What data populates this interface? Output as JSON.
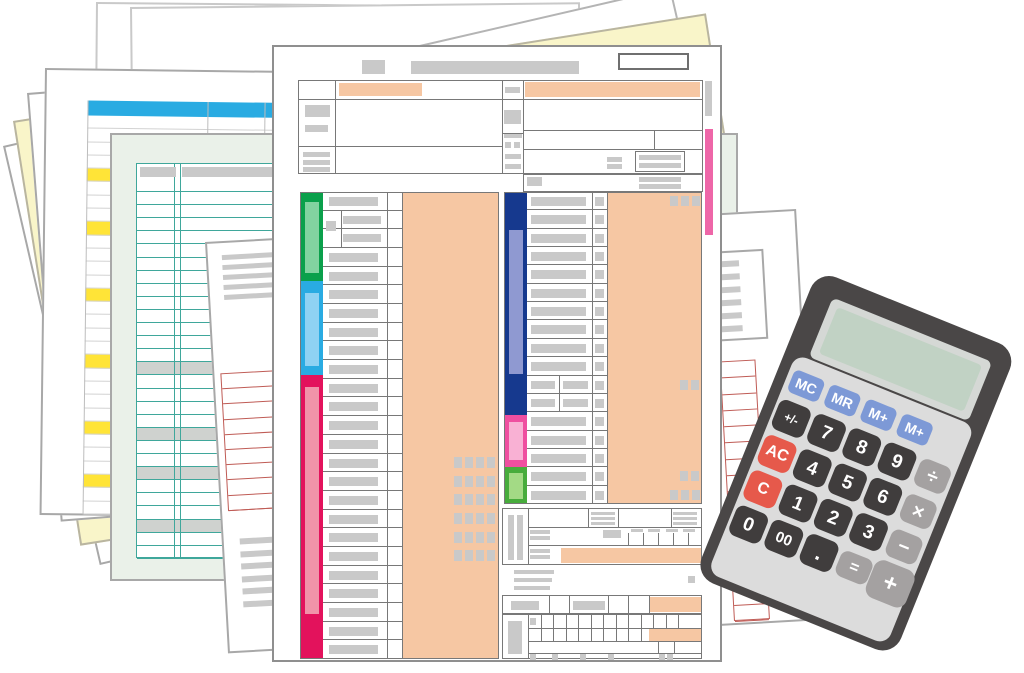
{
  "colors": {
    "page_bg": "#ffffff",
    "sheet_border": "#a8a8a8",
    "form_border": "#8f8f8f",
    "cell_border": "#787878",
    "row_line": "#d2d2d2",
    "gray_bar": "#c9c9c9",
    "gray_fill": "#cfd2cf",
    "peach": "#f6c7a3",
    "blue_header": "#29abe2",
    "yellow_highlight": "#ffe437",
    "fan_yellow": "#f9f5c9",
    "mint_bg": "#eaf1e9",
    "teal_line": "#3fa79b",
    "red_line": "#bf5b55",
    "band_green": "#0aa04b",
    "band_green_light": "#82d3a0",
    "band_blue": "#29abe2",
    "band_blue_light": "#8fd2f3",
    "band_crimson": "#e3125c",
    "band_crimson_light": "#f193a9",
    "band_navy": "#16398e",
    "band_navy_light": "#8f99d1",
    "band_pink": "#ef4fa0",
    "band_pink_light": "#f9b1d4",
    "band_green2": "#47ac3c",
    "band_green2_light": "#a3da85",
    "tab_pink": "#ee66a8",
    "calc_body": "#4a4747",
    "calc_face": "#dcdcdc",
    "calc_screen_frame": "#d5d8d5",
    "calc_screen": "#c1d2c4",
    "btn_dark": "#403d3d",
    "btn_blue": "#7d99d6",
    "btn_red": "#e6594b",
    "btn_gray": "#a4a1a1",
    "btn_text": "#ffffff"
  },
  "calculator": {
    "screen_text": "",
    "memory_row": [
      "MC",
      "MR",
      "M+",
      "M+"
    ],
    "key_rows": [
      [
        "+/-",
        "7",
        "8",
        "9",
        "÷"
      ],
      [
        "AC",
        "4",
        "5",
        "6",
        "×"
      ],
      [
        "C",
        "1",
        "2",
        "3",
        "−"
      ],
      [
        "0",
        "00",
        ".",
        "=",
        "+"
      ]
    ]
  },
  "form": {
    "left_rows": 25,
    "left_indent_rows": [
      1,
      2
    ],
    "left_square_rows": [
      14,
      15,
      16,
      17,
      18,
      19
    ],
    "right_rows": 17,
    "right_split_rows": [
      10,
      11
    ],
    "right_square2_rows": [
      10,
      15
    ],
    "right_square3_rows": [
      0,
      16
    ]
  },
  "sheets": {
    "spreadsheet": {
      "rows": 30,
      "yellow_rows": [
        4,
        8,
        13,
        18,
        23,
        27
      ]
    },
    "ledger": {
      "rows": 29,
      "gray_rows": [
        14,
        19,
        22,
        26
      ]
    },
    "report": {
      "left_red_rows": 9,
      "right_red_rows": 16,
      "para1_lines": 5,
      "para2_lines": 6,
      "panel_lines": 6
    }
  }
}
